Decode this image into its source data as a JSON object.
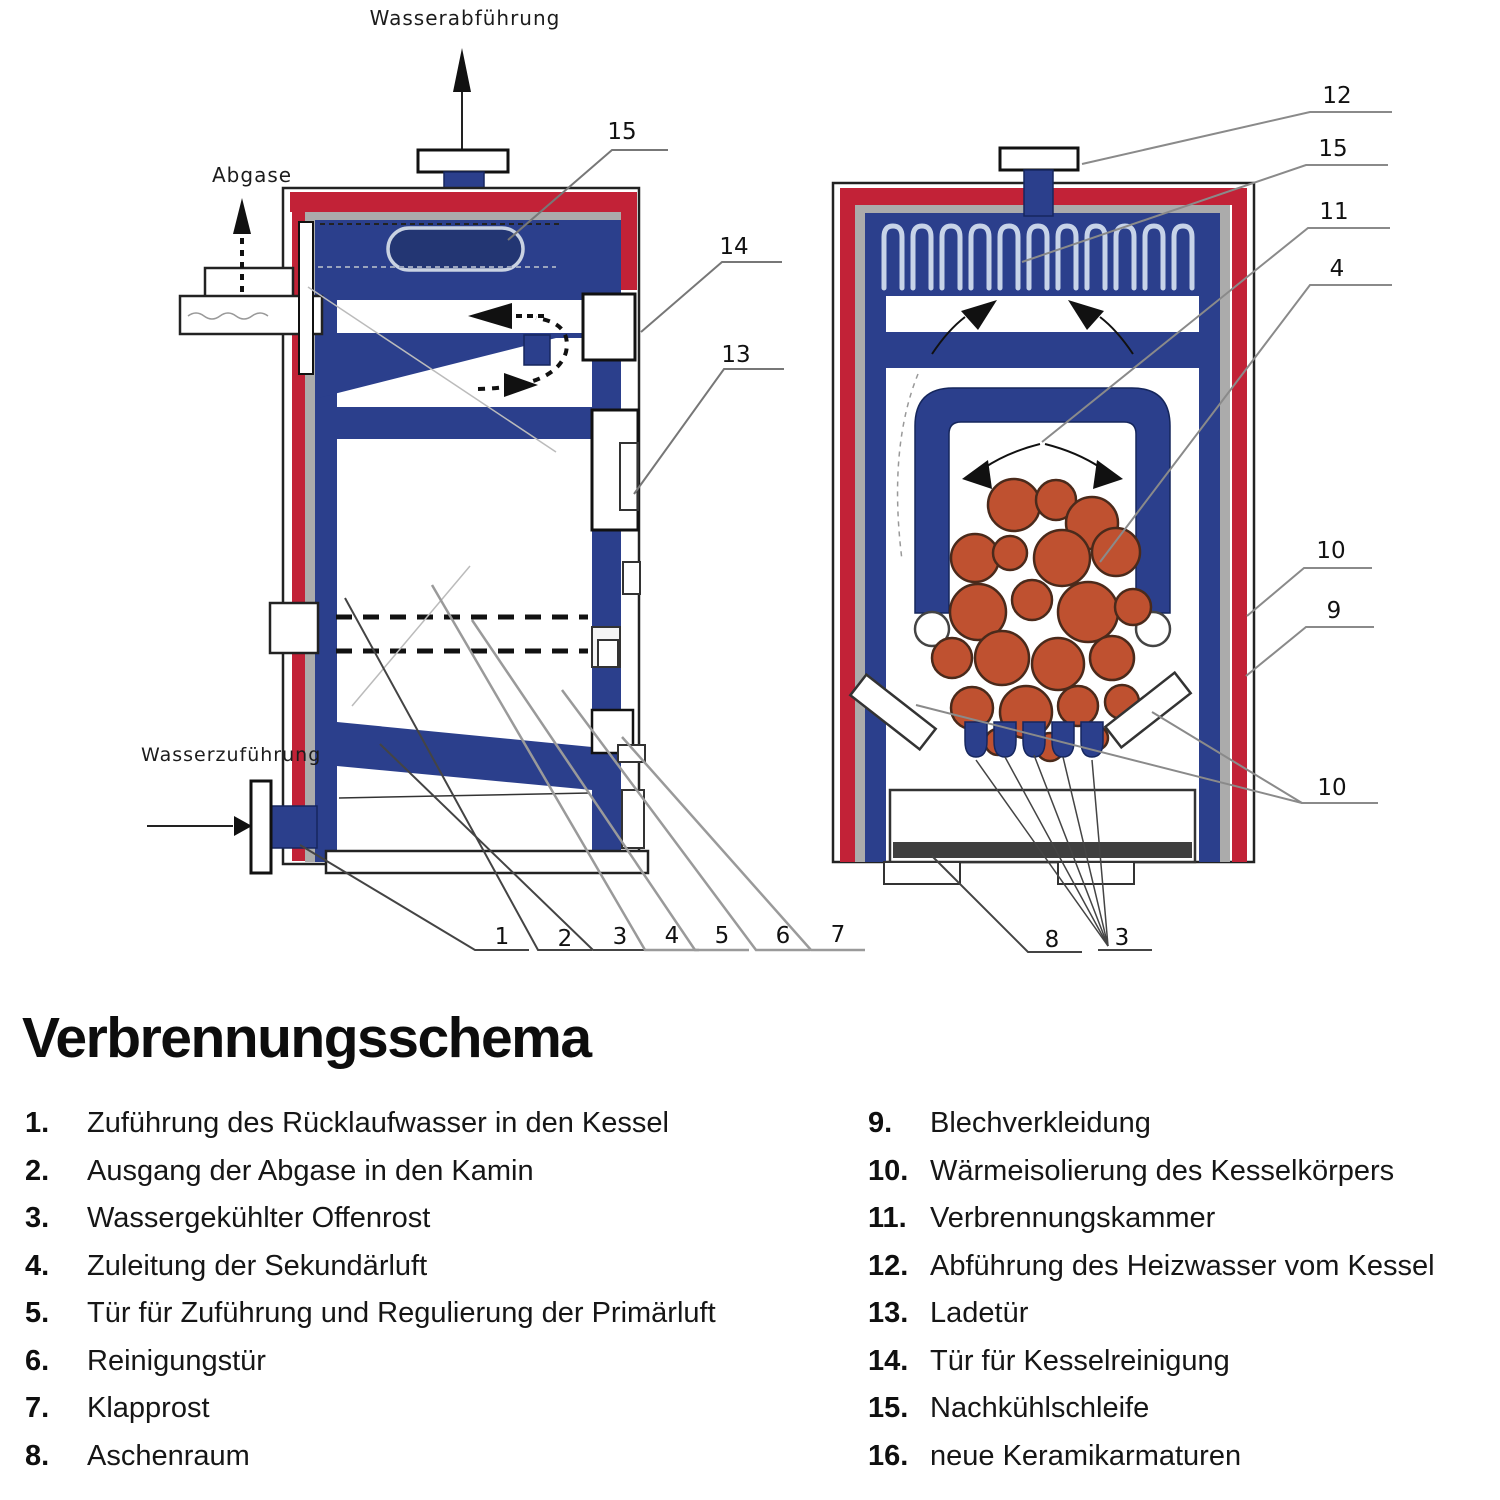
{
  "title": "Verbrennungsschema",
  "diagram_labels": {
    "water_outlet": "Wasserabführung",
    "exhaust_gas": "Abgase",
    "water_inlet": "Wasserzuführung"
  },
  "callouts": {
    "left": [
      "15",
      "14",
      "13"
    ],
    "left_bottom": [
      "1",
      "2",
      "3",
      "4",
      "5",
      "6",
      "7"
    ],
    "right": [
      "12",
      "15",
      "11",
      "4",
      "10",
      "9",
      "10"
    ],
    "right_bottom": [
      "8",
      "3"
    ]
  },
  "legend": {
    "left": [
      {
        "num": "1.",
        "label": "Zuführung des Rücklaufwasser in den Kessel"
      },
      {
        "num": "2.",
        "label": "Ausgang der Abgase in den Kamin"
      },
      {
        "num": "3.",
        "label": "Wassergekühlter Offenrost"
      },
      {
        "num": "4.",
        "label": "Zuleitung der Sekundärluft"
      },
      {
        "num": "5.",
        "label": "Tür für Zuführung und Regulierung der Primärluft"
      },
      {
        "num": "6.",
        "label": "Reinigungstür"
      },
      {
        "num": "7.",
        "label": "Klapprost"
      },
      {
        "num": "8.",
        "label": "Aschenraum"
      }
    ],
    "right": [
      {
        "num": "9.",
        "label": "Blechverkleidung"
      },
      {
        "num": "10.",
        "label": "Wärmeisolierung des Kesselkörpers"
      },
      {
        "num": "11.",
        "label": "Verbrennungskammer"
      },
      {
        "num": "12.",
        "label": "Abführung des Heizwasser vom Kessel"
      },
      {
        "num": "13.",
        "label": "Ladetür"
      },
      {
        "num": "14.",
        "label": "Tür für Kesselreinigung"
      },
      {
        "num": "15.",
        "label": "Nachkühlschleife"
      },
      {
        "num": "16.",
        "label": "neue Keramikarmaturen"
      }
    ]
  },
  "colors": {
    "boiler-blue": "#2b3f8c",
    "cladding-red": "#c22237",
    "insulation-gray": "#ababab",
    "coal-orange": "#bf5130",
    "ash-dark": "#3f3f3f"
  }
}
